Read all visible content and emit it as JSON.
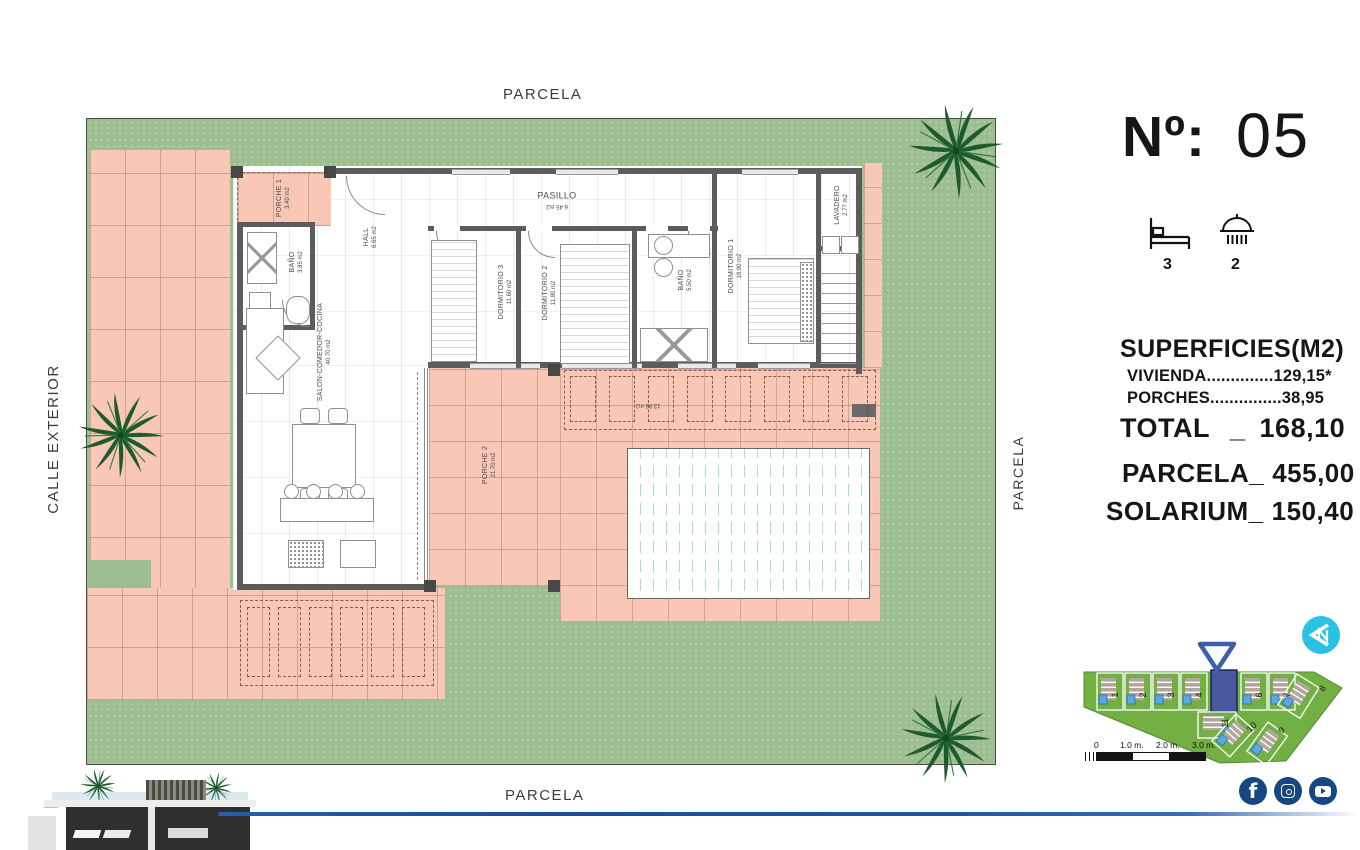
{
  "plan": {
    "parcela_top": "PARCELA",
    "parcela_bottom": "PARCELA",
    "parcela_right": "PARCELA",
    "calle_exterior": "CALLE EXTERIOR",
    "rooms": {
      "porche1": {
        "name": "PORCHE 1",
        "area": "3.40 m2"
      },
      "bano1": {
        "name": "BAÑO",
        "area": "3.85 m2"
      },
      "hall": {
        "name": "HALL",
        "area": "6.65 m2"
      },
      "pasillo": {
        "name": "PASILLO",
        "area": "6.45 m2"
      },
      "dorm3": {
        "name": "DORMITORIO 3",
        "area": "11.60 m2"
      },
      "dorm2": {
        "name": "DORMITORIO 2",
        "area": "11.80 m2"
      },
      "bano2": {
        "name": "BAÑO",
        "area": "5.50 m2"
      },
      "dorm1": {
        "name": "DORMITORIO 1",
        "area": "18.90 m2"
      },
      "lavadero": {
        "name": "LAVADERO",
        "area": "2.77 m2"
      },
      "salon": {
        "name": "SALON-COMEDOR-COCINA",
        "area": "40.70 m2"
      },
      "porche2": {
        "name": "PORCHE 2",
        "area": "21.70 m2"
      }
    },
    "pergola_area": "13.86 m2"
  },
  "panel": {
    "number_label": "Nº:",
    "number_value": "05",
    "bedrooms": "3",
    "bathrooms": "2",
    "superficies_title": "SUPERFICIES(M2)",
    "vivienda_line": "VIVIENDA..............129,15*",
    "porches_line": "PORCHES...............38,95",
    "total_label": "TOTAL",
    "total_sep": "_",
    "total_value": "168,10",
    "parcela_label": "PARCELA_",
    "parcela_value": "455,00",
    "solarium_label": "SOLARIUM_",
    "solarium_value": "150,40"
  },
  "siteplan": {
    "plots": [
      "1",
      "2",
      "3",
      "4",
      "5",
      "6",
      "7",
      "8",
      "9",
      "10",
      "11"
    ],
    "highlighted_plot": "5",
    "scale_ticks": [
      "0",
      "1.0 m.",
      "2.0 m.",
      "3.0 m."
    ],
    "north_label": "N"
  },
  "icons": {
    "social": [
      "facebook",
      "instagram",
      "youtube"
    ]
  },
  "colors": {
    "grass_green": "#9cbe90",
    "paving_salmon": "#f8c7b5",
    "site_green": "#72b043",
    "highlight_blue": "#47589f",
    "north_cyan": "#2ac2e4",
    "social_navy": "#17477f",
    "divider_blue": "#2456a2"
  }
}
